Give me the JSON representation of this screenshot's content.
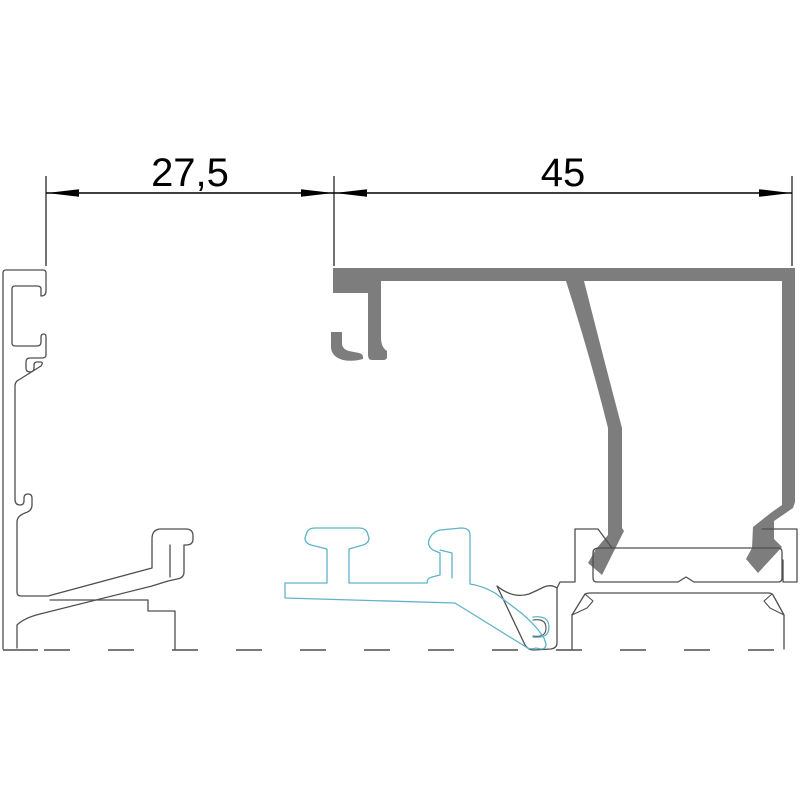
{
  "drawing": {
    "title": "Aluminium profile cross-section",
    "canvas": {
      "width": 800,
      "height": 800,
      "background": "#ffffff"
    }
  },
  "colors": {
    "outline": "#4f4f4f",
    "fill_gray": "#7d7d7d",
    "cyan": "#5fb3c8",
    "dimension": "#000000"
  },
  "dimension_annotation": {
    "line_y": 193,
    "ext_top": 176,
    "ext_bottom": 266,
    "arrow_length": 32,
    "arrow_half_width": 3.8,
    "font_size": 40,
    "extension_lines": [
      46,
      334,
      792
    ],
    "dims": [
      {
        "id": "dim-left",
        "label": "27,5",
        "value": 27.5,
        "x1": 46,
        "x2": 334,
        "label_x": 190,
        "label_y": 186
      },
      {
        "id": "dim-right",
        "label": "45",
        "value": 45,
        "x1": 334,
        "x2": 792,
        "label_x": 563,
        "label_y": 186
      }
    ]
  },
  "parts": [
    {
      "id": "left-jamb-profile",
      "style": "thin outline"
    },
    {
      "id": "sash-profile",
      "style": "gray filled"
    },
    {
      "id": "gasket-and-clips",
      "style": "cyan outline"
    },
    {
      "id": "bottom-frame",
      "style": "thin outline, dashed break line"
    }
  ]
}
